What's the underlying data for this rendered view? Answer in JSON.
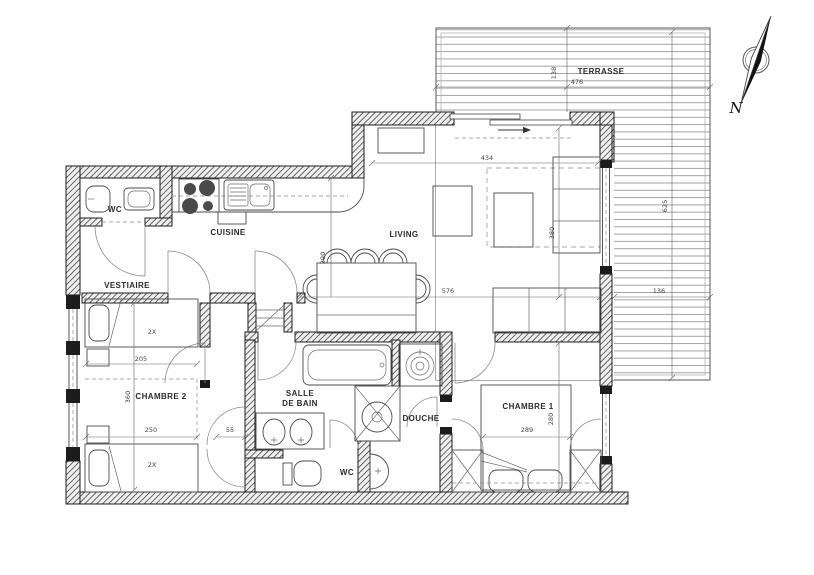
{
  "page": {
    "background": "#ffffff"
  },
  "rooms": {
    "terrasse": "TERRASSE",
    "wc_top": "WC",
    "cuisine": "CUISINE",
    "living": "LIVING",
    "vestiaire": "VESTIAIRE",
    "chambre2": "CHAMBRE 2",
    "salle_de_bain_line1": "SALLE",
    "salle_de_bain_line2": "DE BAIN",
    "douche": "DOUCHE",
    "wc_bottom": "WC",
    "chambre1": "CHAMBRE 1"
  },
  "dimensions_cm": {
    "terrasse_depth": "138",
    "terrasse_width": "476",
    "terrasse_side_height": "625",
    "terrasse_side_width": "136",
    "living_width_top": "434",
    "living_height": "380",
    "living_width_bottom": "576",
    "dining_depth": "290",
    "chambre2_bed_length": "205",
    "chambre2_depth": "360",
    "chambre2_width": "250",
    "passage_width": "55",
    "chambre1_width": "289",
    "chambre1_depth": "280"
  },
  "annotations": {
    "bed1_capacity": "2X",
    "bed2_capacity": "2X",
    "north": "N"
  },
  "colors": {
    "wall_line": "#1c1c1c",
    "fixture_line": "#4a4a4a",
    "deck_line": "#8d8d8d",
    "dim_line": "#666666",
    "text": "#2b2b2b"
  }
}
